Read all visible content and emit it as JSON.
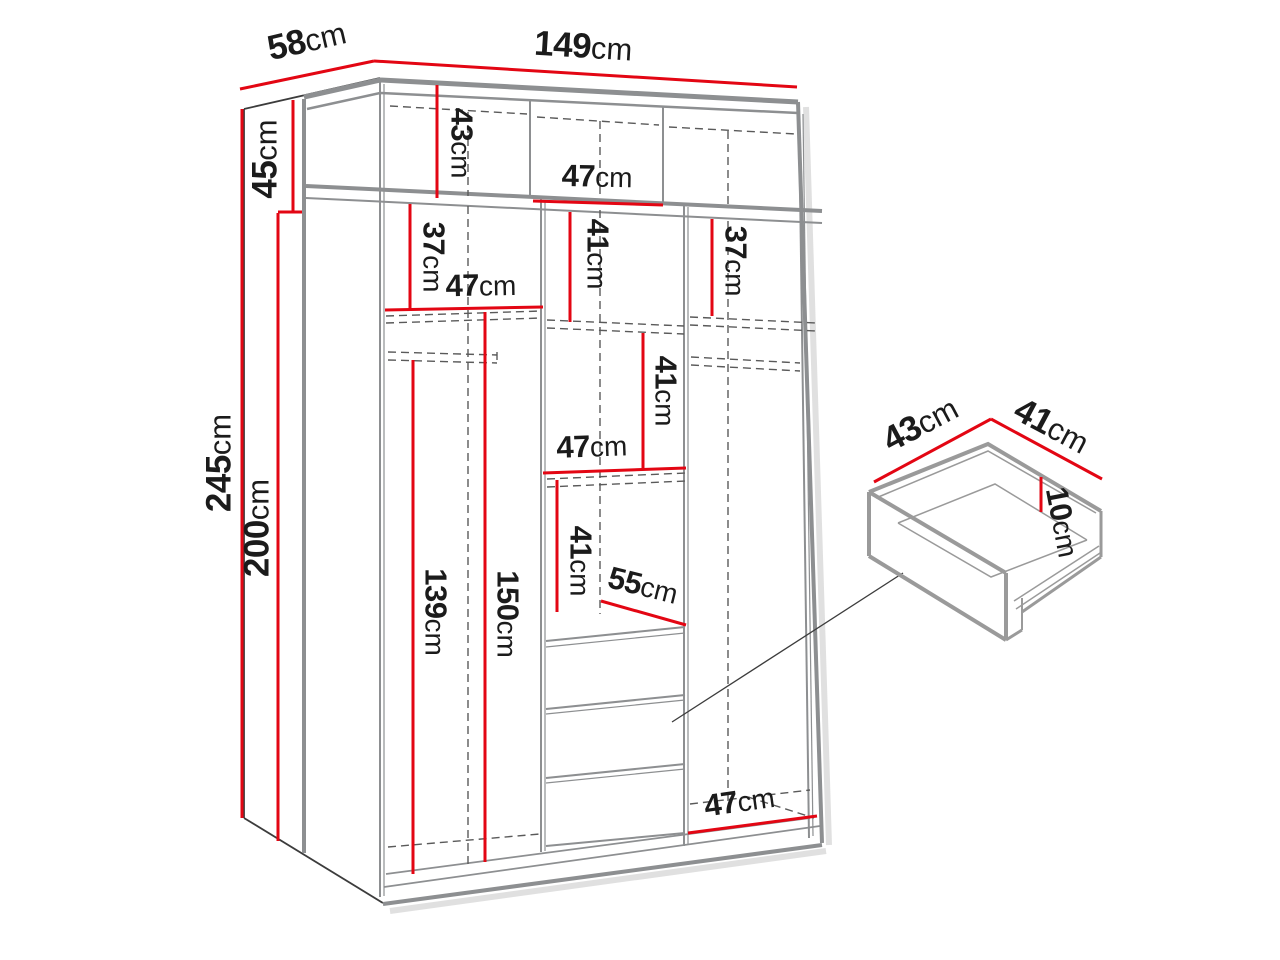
{
  "title": "wardrobe-dimension-diagram",
  "unit": "cm",
  "colors": {
    "dimension_red": "#e30613",
    "structure_gray": "#8d8f91"
  },
  "dims": {
    "depth": "58",
    "width": "149",
    "upper_section_height": "45",
    "total_height": "245",
    "body_height": "200",
    "top_shelf_height": "43",
    "top_middle_width": "47",
    "left_upper_shelf_height": "37",
    "middle_upper_shelf_height": "41",
    "right_upper_shelf_height": "37",
    "left_shelf_width": "47",
    "middle_second_shelf_height": "41",
    "middle_shelf_width": "47",
    "middle_third_shelf_height": "41",
    "drawer_front_width": "55",
    "left_hanging_height": "139",
    "left_inner_height": "150",
    "right_bottom_width": "47",
    "drawer_depth": "43",
    "drawer_width": "41",
    "drawer_height": "10"
  }
}
